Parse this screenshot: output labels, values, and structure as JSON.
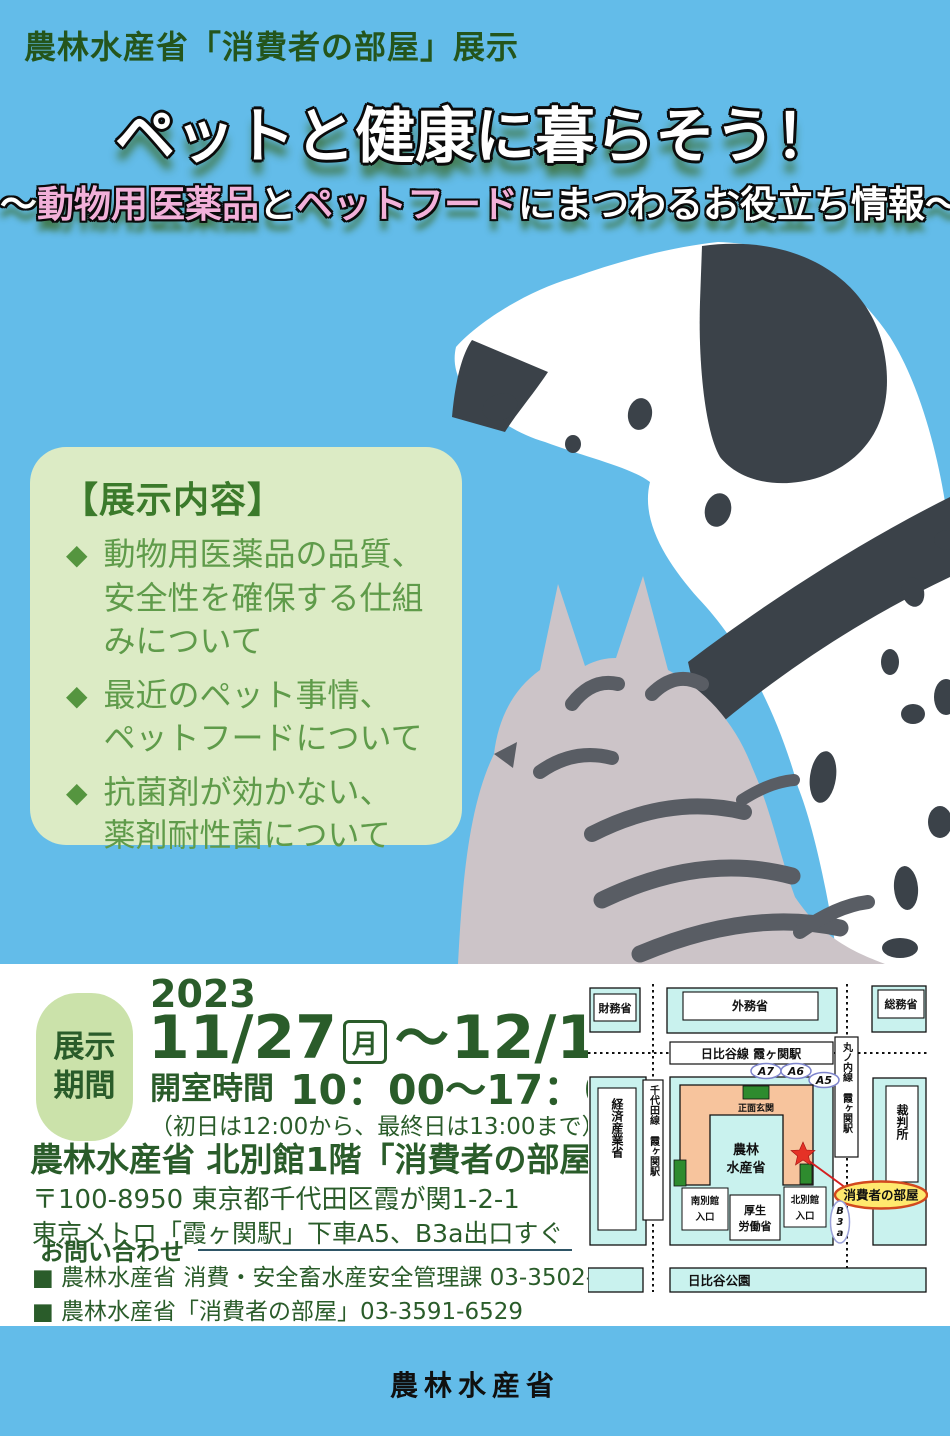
{
  "colors": {
    "background_blue": "#63bce9",
    "dark_green_text": "#2a5c2a",
    "exhibit_box_green": "#dcebc5",
    "exhibit_text_green": "#5f9b4a",
    "period_badge_green": "#cbe2aa",
    "subtitle_pink": "#f2b0d9",
    "title_shadow_green": "#3a6c2c",
    "map_cyan": "#c9f2ee",
    "map_salmon": "#f7c49d",
    "map_entrance_green": "#2e8b2e",
    "map_star_red": "#e53226",
    "map_oval_yellow": "#ffe96e",
    "map_oval_border_red": "#d2491e"
  },
  "poster": {
    "agency_line": "農林水産省「消費者の部屋」展示",
    "title": "ペットと健康に暮らそう！",
    "subtitle": {
      "s1": "～",
      "s2": "動物用医薬品",
      "s3": "と",
      "s4": "ペットフード",
      "s5": "にまつわるお役立ち情報～"
    }
  },
  "exhibit": {
    "heading": "【展示内容】",
    "bullet": "◆",
    "items": [
      {
        "text": "動物用医薬品の品質、\n安全性を確保する仕組\nみについて"
      },
      {
        "text": "最近のペット事情、\nペットフードについて"
      },
      {
        "text": "抗菌剤が効かない、\n薬剤耐性菌について"
      }
    ]
  },
  "schedule": {
    "period_label": "展示\n期間",
    "year": "2023",
    "start_date": "11/27",
    "start_day": "月",
    "range_mark": "～",
    "end_date": "12/1",
    "end_day": "金",
    "hours_label": "開室時間",
    "hours": "10：00～17：00",
    "note": "（初日は12:00から、最終日は13:00まで）"
  },
  "venue": {
    "name": "農林水産省 北別館1階「消費者の部屋」",
    "address": "〒100-8950 東京都千代田区霞が関1-2-1",
    "access": "東京メトロ「霞ヶ関駅」下車A5、B3a出口すぐ"
  },
  "contact": {
    "label": "お問い合わせ",
    "items": [
      {
        "text": "■ 農林水産省 消費・安全畜水産安全管理課 03-3502-8097"
      },
      {
        "text": "■ 農林水産省「消費者の部屋」03-3591-6529"
      }
    ]
  },
  "map": {
    "buildings": {
      "zaimu": "財務省",
      "gaimu": "外務省",
      "somu": "総務省",
      "keisan": "経済産業省",
      "saiban": "裁判所",
      "maff1": "農林",
      "maff2": "水産省",
      "mhlw1": "厚生",
      "mhlw2": "労働省"
    },
    "stations": {
      "hibiya": "日比谷線 霞ヶ関駅",
      "marunouchi": "丸ノ内線 霞ヶ関駅",
      "chiyoda": "千代田線 霞ヶ関駅"
    },
    "exits": {
      "a7": "A7",
      "a6": "A6",
      "a5": "A5",
      "b3a": "B3a"
    },
    "labels": {
      "front_entrance": "正面玄関",
      "south1": "南別館",
      "south2": "入口",
      "north1": "北別館",
      "north2": "入口",
      "consumer_room": "消費者の部屋",
      "park": "日比谷公園"
    }
  },
  "footer": {
    "org": "農林水産省"
  }
}
